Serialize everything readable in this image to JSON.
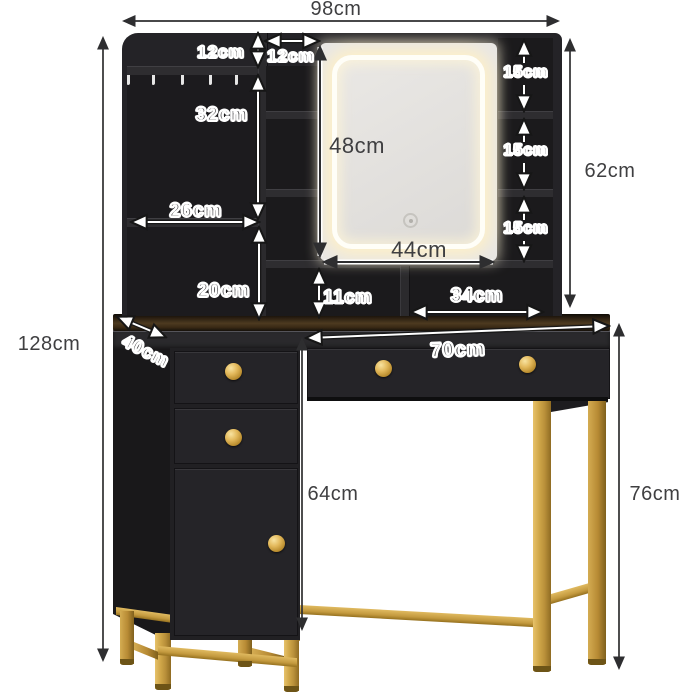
{
  "diagram": {
    "type": "furniture-dimension-diagram",
    "product": "vanity table with LED mirror, hutch shelves and drawers",
    "unit": "cm"
  },
  "dimensions": {
    "overall_width": "98cm",
    "overall_height": "128cm",
    "hutch_height": "62cm",
    "table_height": "76cm",
    "knee_clearance_height": "64cm",
    "top_shelf_height": "12cm",
    "middle_column_width": "12cm",
    "left_compartment_height": "32cm",
    "left_shelf_width": "26cm",
    "left_lower_compartment_height": "20cm",
    "mirror_height": "48cm",
    "mirror_width": "44cm",
    "right_cubby_heights": [
      "15cm",
      "15cm",
      "15cm"
    ],
    "under_mirror_height": "11cm",
    "under_mirror_width": "34cm",
    "desk_depth": "40cm",
    "tabletop_width": "70cm"
  },
  "colors": {
    "background": "#ffffff",
    "furniture_black": "#242327",
    "recess_black": "#1c1b1e",
    "gold_accent": "#c79b3f",
    "wood_top": "#4a351d",
    "led_glow": "#fff2cd",
    "mirror_face": "#e9e7e4",
    "dimension_text_dark": "#3f3f41",
    "dimension_text_outlined": "#ffffff"
  }
}
